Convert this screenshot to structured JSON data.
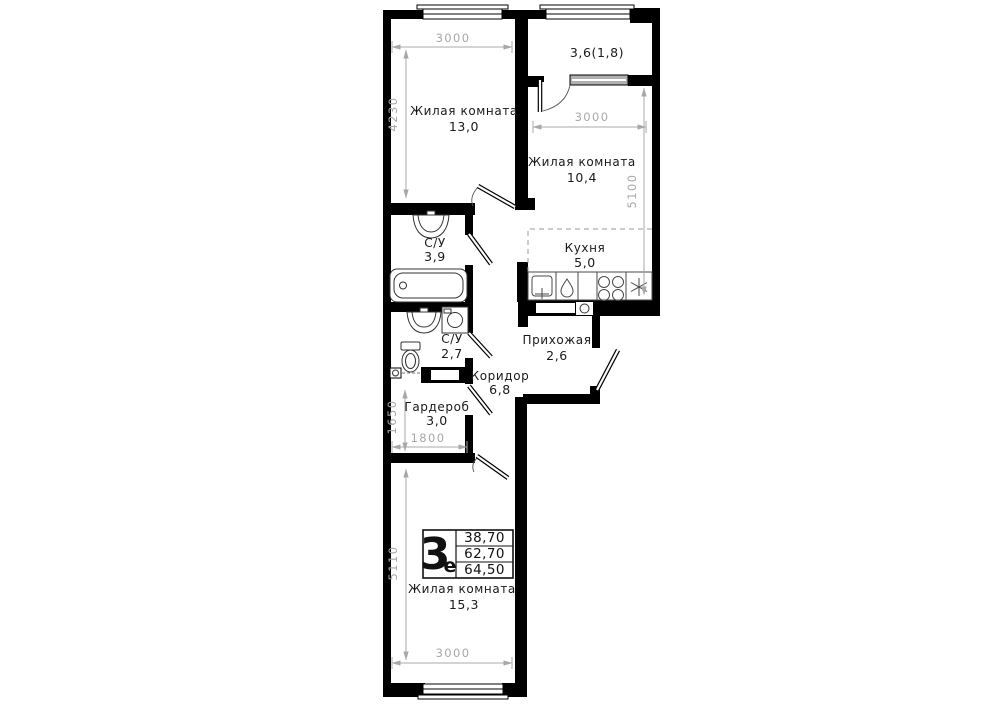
{
  "plan": {
    "rooms": {
      "living1": {
        "label": "Жилая комната",
        "area": "13,0"
      },
      "balcony": {
        "label": "3,6(1,8)"
      },
      "living2": {
        "label": "Жилая комната",
        "area": "10,4"
      },
      "kitchen": {
        "label": "Кухня",
        "area": "5,0"
      },
      "bath1": {
        "label": "С/У",
        "area": "3,9"
      },
      "bath2": {
        "label": "С/У",
        "area": "2,7"
      },
      "hall": {
        "label": "Прихожая",
        "area": "2,6"
      },
      "corridor": {
        "label": "Коридор",
        "area": "6,8"
      },
      "wardrobe": {
        "label": "Гардероб",
        "area": "3,0"
      },
      "living3": {
        "label": "Жилая комната",
        "area": "15,3"
      }
    },
    "dims": {
      "living1_width": "3000",
      "living1_depth": "4230",
      "living2_width": "3000",
      "living2_depth": "5100",
      "wardrobe_depth": "1650",
      "wardrobe_width": "1800",
      "living3_depth": "5110",
      "living3_width": "3000"
    },
    "stamp": {
      "type_number": "3",
      "type_letter": "е",
      "areas": [
        "38,70",
        "62,70",
        "64,50"
      ]
    },
    "colors": {
      "wall": "#000000",
      "dimension": "#a8a8a8",
      "label": "#1a1a1a",
      "glazing": "#b0b0b0"
    }
  }
}
